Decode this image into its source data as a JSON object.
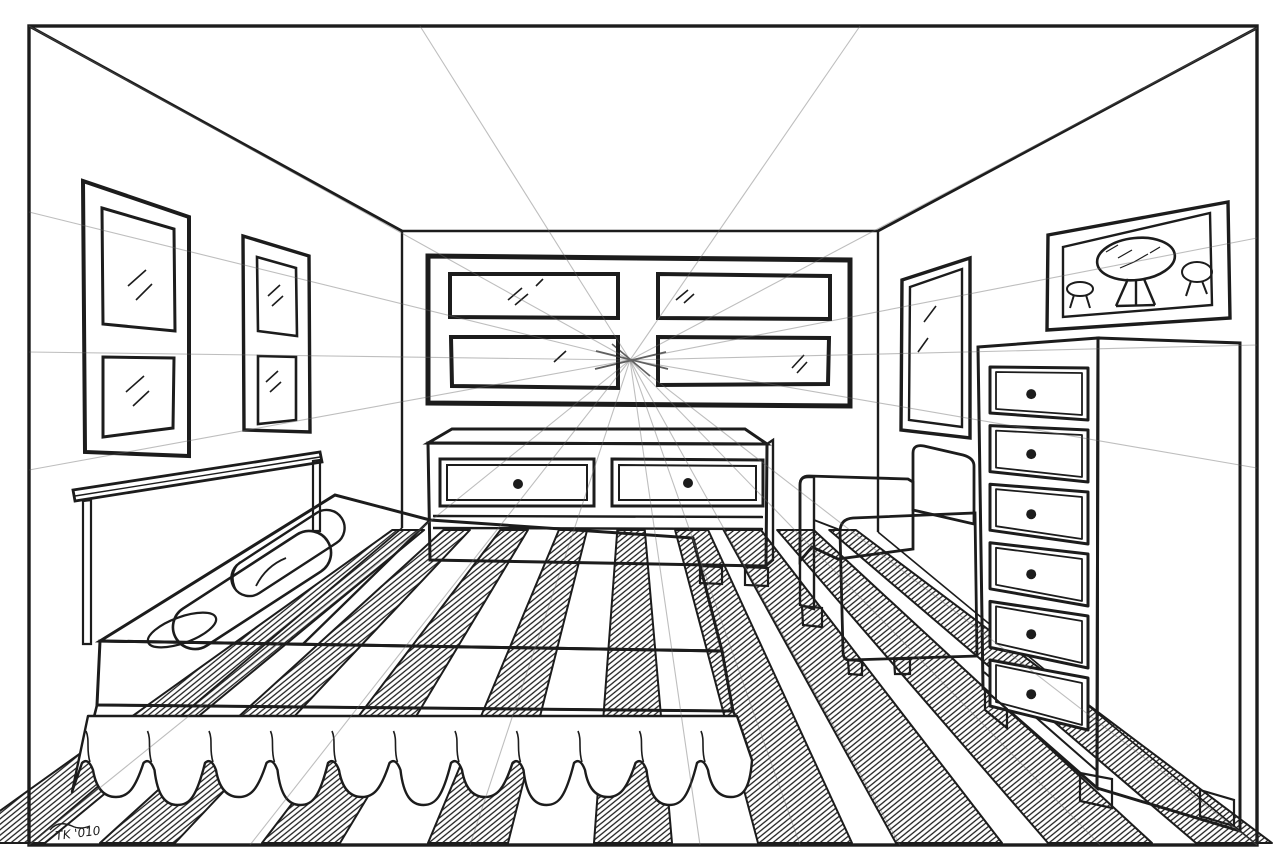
{
  "artwork": {
    "type": "one-point perspective ink line drawing",
    "subject": "bedroom interior with bed, dressers, armchair, striped rug, window and framed pictures",
    "paper_color": "#ffffff",
    "ink_color": "#1c1c1c",
    "guide_line_color": "#666666"
  },
  "signature": {
    "text": "TK '010"
  },
  "scene": {
    "vanishing_point": {
      "x": 630,
      "y": 360
    },
    "border": {
      "x": 29,
      "y": 26,
      "width": 1228,
      "height": 819
    },
    "objects": [
      "picture-frame-left-near",
      "picture-frame-left-far",
      "back-wall-window",
      "right-wall-frame",
      "right-wall-picture",
      "low-dresser",
      "bed-with-skirt",
      "bolster-pillows",
      "armchair",
      "tall-chest-of-drawers",
      "striped-rug",
      "perspective-guide-lines"
    ],
    "low_dresser": {
      "drawer_count": 2,
      "knob_style": "round-black"
    },
    "tall_chest": {
      "drawer_count": 6,
      "knob_style": "round-black",
      "geometry": {
        "left_x": 990,
        "right_x": 1088,
        "left_top0": 367,
        "left_step": 58.6,
        "left_h": 46,
        "right_top0": 368,
        "right_step": 62,
        "right_h": 52,
        "inset": 6,
        "knob_t": 0.42,
        "knob_r": 5
      }
    },
    "rug": {
      "style": "alternating hatched wedge stripes converging at the vanishing point",
      "hatched_stripe_count": 9,
      "hatched_stripes_bottom_x": [
        [
          -45,
          45
        ],
        [
          100,
          175
        ],
        [
          262,
          340
        ],
        [
          428,
          508
        ],
        [
          594,
          672
        ],
        [
          758,
          852
        ],
        [
          896,
          1002
        ],
        [
          1048,
          1152
        ],
        [
          1196,
          1272
        ]
      ],
      "bottom_y": 843,
      "back_floor_y": 530
    },
    "bed_skirt": {
      "scallop_count": 11,
      "right_x": 752,
      "step": 61.5,
      "top_y": 716,
      "cusp_y": 762,
      "bulb_y": 800
    },
    "guide_rays": {
      "count": 18,
      "targets": [
        [
          29,
          26
        ],
        [
          420,
          26
        ],
        [
          860,
          26
        ],
        [
          1257,
          28
        ],
        [
          29,
          212
        ],
        [
          29,
          352
        ],
        [
          29,
          470
        ],
        [
          29,
          845
        ],
        [
          250,
          845
        ],
        [
          470,
          845
        ],
        [
          700,
          845
        ],
        [
          800,
          845
        ],
        [
          900,
          845
        ],
        [
          1100,
          845
        ],
        [
          1257,
          845
        ],
        [
          1257,
          468
        ],
        [
          1257,
          345
        ],
        [
          1257,
          238
        ]
      ]
    }
  }
}
